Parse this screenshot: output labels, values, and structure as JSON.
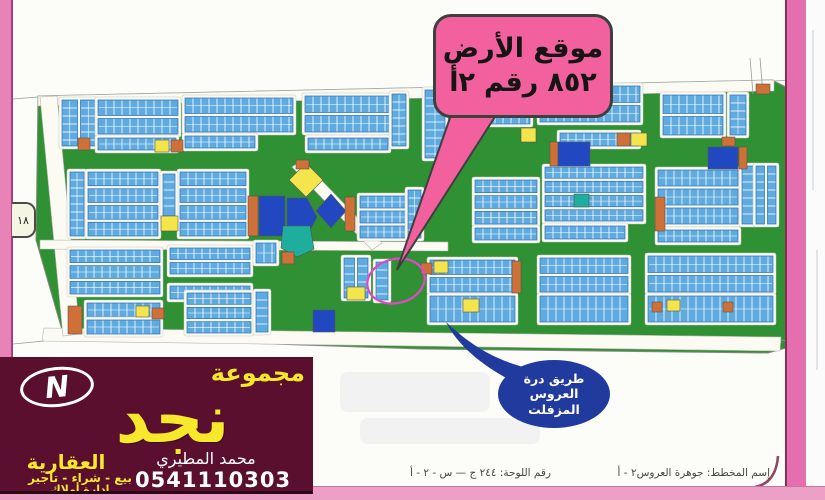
{
  "tab": {
    "label": "١٨"
  },
  "callout": {
    "line1": "موقع الأرض",
    "line2": "أ٢ رقم ٨٥٢",
    "line2_parts": [
      "أ٢",
      "رقم",
      "٨٥٢"
    ],
    "fill": "#f2609d"
  },
  "road_bubble": {
    "lines": [
      "طريق درة",
      "العروس",
      "المزفلت"
    ],
    "fill": "#203a9d"
  },
  "sheet_footer": {
    "plate_label": "رقم اللوحة: ٢٤٤ ج — س - ٢ - أ",
    "plan_label": "إسم المخطط: جوهرة العروس٢ - أ"
  },
  "banner": {
    "group_word": "مجموعة",
    "brand": "نجد",
    "subtitle": "العقارية",
    "services": "بيع - شراء - تاجير",
    "services2": "إدارة أملاك",
    "agent": "محمد المطيري",
    "phone": "0541110303",
    "logo_letter": "N",
    "background": "#5a0f2e",
    "accent": "#f7e82c"
  },
  "frame": {
    "stripe_left": "#e783b7",
    "stripe_right": "#e46fae",
    "strip_bottom": "#eda0c6"
  },
  "map": {
    "colors": {
      "green": "#2f9134",
      "plot": "#5fabe0",
      "plotEdge": "#2d6eb5",
      "royal": "#2148c0",
      "yellow": "#f3e54b",
      "orange": "#cf7038",
      "teal": "#1fae9e",
      "circle": "#e048c8",
      "street": "#fbfbf3"
    },
    "green_outline": [
      [
        38,
        96
      ],
      [
        772,
        80
      ],
      [
        786,
        87
      ],
      [
        786,
        348
      ],
      [
        768,
        353
      ],
      [
        420,
        349
      ],
      [
        64,
        337
      ],
      [
        36,
        240
      ]
    ],
    "roads": [
      [
        [
          38,
          96
        ],
        [
          774,
          80
        ],
        [
          774,
          91
        ],
        [
          38,
          106
        ]
      ],
      [
        [
          44,
          328
        ],
        [
          781,
          337
        ],
        [
          780,
          351
        ],
        [
          42,
          341
        ]
      ],
      [
        [
          40,
          97
        ],
        [
          57,
          96
        ],
        [
          80,
          334
        ],
        [
          63,
          336
        ]
      ],
      [
        [
          40,
          240
        ],
        [
          448,
          242
        ],
        [
          448,
          251
        ],
        [
          40,
          249
        ]
      ],
      [
        [
          292,
          167
        ],
        [
          302,
          160
        ],
        [
          382,
          243
        ],
        [
          372,
          250
        ]
      ]
    ],
    "blocks": [
      [
        62,
        100,
        34,
        46,
        2,
        "v"
      ],
      [
        98,
        100,
        80,
        34,
        2,
        "h"
      ],
      [
        98,
        138,
        78,
        12,
        1,
        "h"
      ],
      [
        185,
        98,
        108,
        34,
        2,
        "h"
      ],
      [
        185,
        136,
        70,
        12,
        1,
        "h"
      ],
      [
        305,
        96,
        85,
        36,
        2,
        "h"
      ],
      [
        308,
        138,
        80,
        12,
        1,
        "h"
      ],
      [
        392,
        94,
        14,
        52,
        1,
        "v"
      ],
      [
        425,
        90,
        20,
        68,
        1,
        "v"
      ],
      [
        455,
        88,
        75,
        36,
        2,
        "h"
      ],
      [
        540,
        86,
        100,
        36,
        2,
        "h"
      ],
      [
        560,
        133,
        78,
        13,
        1,
        "h"
      ],
      [
        663,
        95,
        60,
        40,
        2,
        "h"
      ],
      [
        730,
        95,
        16,
        40,
        1,
        "v"
      ],
      [
        70,
        172,
        14,
        64,
        1,
        "v"
      ],
      [
        88,
        172,
        70,
        64,
        4,
        "h"
      ],
      [
        180,
        172,
        66,
        64,
        4,
        "h"
      ],
      [
        163,
        174,
        12,
        42,
        1,
        "v"
      ],
      [
        360,
        196,
        46,
        42,
        3,
        "h"
      ],
      [
        408,
        190,
        13,
        48,
        1,
        "v"
      ],
      [
        475,
        180,
        62,
        44,
        3,
        "h"
      ],
      [
        475,
        228,
        62,
        12,
        1,
        "h"
      ],
      [
        545,
        167,
        98,
        54,
        4,
        "h"
      ],
      [
        545,
        226,
        80,
        13,
        1,
        "h"
      ],
      [
        658,
        170,
        80,
        54,
        3,
        "h"
      ],
      [
        658,
        230,
        80,
        12,
        1,
        "h"
      ],
      [
        742,
        166,
        12,
        58,
        1,
        "v"
      ],
      [
        756,
        166,
        20,
        58,
        2,
        "v"
      ],
      [
        70,
        250,
        90,
        44,
        3,
        "h"
      ],
      [
        170,
        248,
        80,
        26,
        2,
        "h"
      ],
      [
        170,
        286,
        80,
        13,
        1,
        "h"
      ],
      [
        87,
        303,
        73,
        14,
        1,
        "h"
      ],
      [
        87,
        320,
        73,
        14,
        1,
        "h"
      ],
      [
        187,
        293,
        64,
        40,
        3,
        "h"
      ],
      [
        256,
        292,
        12,
        40,
        1,
        "v"
      ],
      [
        256,
        243,
        20,
        20,
        1,
        "h"
      ],
      [
        344,
        258,
        24,
        40,
        2,
        "v"
      ],
      [
        376,
        262,
        12,
        38,
        1,
        "v"
      ],
      [
        430,
        260,
        85,
        32,
        2,
        "h"
      ],
      [
        430,
        296,
        85,
        26,
        1,
        "h"
      ],
      [
        540,
        258,
        88,
        34,
        2,
        "h"
      ],
      [
        540,
        296,
        88,
        26,
        1,
        "h"
      ],
      [
        648,
        256,
        125,
        36,
        2,
        "h"
      ],
      [
        648,
        296,
        125,
        26,
        1,
        "h"
      ]
    ],
    "specials": [
      {
        "x": 155,
        "y": 140,
        "w": 14,
        "h": 12,
        "c": "yellow"
      },
      {
        "x": 171,
        "y": 140,
        "w": 12,
        "h": 12,
        "c": "orange"
      },
      {
        "x": 78,
        "y": 138,
        "w": 12,
        "h": 12,
        "c": "orange"
      },
      {
        "x": 161,
        "y": 216,
        "w": 17,
        "h": 15,
        "c": "yellow"
      },
      {
        "x": 248,
        "y": 196,
        "w": 10,
        "h": 40,
        "c": "orange"
      },
      {
        "x": 259,
        "y": 196,
        "w": 26,
        "h": 40,
        "c": "royal"
      },
      {
        "pts": [
          [
            287,
            198
          ],
          [
            307,
            198
          ],
          [
            317,
            217
          ],
          [
            307,
            236
          ],
          [
            287,
            236
          ]
        ],
        "c": "royal"
      },
      {
        "pts": [
          [
            306,
            163
          ],
          [
            323,
            180
          ],
          [
            306,
            197
          ],
          [
            289,
            180
          ]
        ],
        "c": "yellow"
      },
      {
        "x": 296,
        "y": 160,
        "w": 13,
        "h": 9,
        "c": "orange"
      },
      {
        "pts": [
          [
            331,
            194
          ],
          [
            346,
            211
          ],
          [
            331,
            228
          ],
          [
            316,
            211
          ]
        ],
        "c": "royal"
      },
      {
        "pts": [
          [
            283,
            226
          ],
          [
            310,
            226
          ],
          [
            314,
            249
          ],
          [
            297,
            257
          ],
          [
            281,
            248
          ]
        ],
        "c": "teal"
      },
      {
        "x": 345,
        "y": 197,
        "w": 10,
        "h": 34,
        "c": "orange"
      },
      {
        "x": 136,
        "y": 306,
        "w": 13,
        "h": 11,
        "c": "yellow"
      },
      {
        "x": 152,
        "y": 308,
        "w": 12,
        "h": 11,
        "c": "orange"
      },
      {
        "x": 68,
        "y": 306,
        "w": 14,
        "h": 28,
        "c": "orange"
      },
      {
        "x": 313,
        "y": 310,
        "w": 22,
        "h": 22,
        "c": "royal"
      },
      {
        "x": 347,
        "y": 287,
        "w": 18,
        "h": 13,
        "c": "yellow"
      },
      {
        "x": 617,
        "y": 133,
        "w": 13,
        "h": 13,
        "c": "orange"
      },
      {
        "x": 631,
        "y": 133,
        "w": 16,
        "h": 13,
        "c": "yellow"
      },
      {
        "x": 550,
        "y": 142,
        "w": 8,
        "h": 24,
        "c": "orange"
      },
      {
        "x": 558,
        "y": 142,
        "w": 32,
        "h": 24,
        "c": "royal"
      },
      {
        "x": 708,
        "y": 147,
        "w": 30,
        "h": 22,
        "c": "royal"
      },
      {
        "x": 739,
        "y": 147,
        "w": 8,
        "h": 22,
        "c": "orange"
      },
      {
        "x": 722,
        "y": 137,
        "w": 13,
        "h": 9,
        "c": "orange"
      },
      {
        "x": 655,
        "y": 197,
        "w": 10,
        "h": 34,
        "c": "orange"
      },
      {
        "x": 434,
        "y": 261,
        "w": 14,
        "h": 12,
        "c": "yellow"
      },
      {
        "x": 421,
        "y": 263,
        "w": 11,
        "h": 11,
        "c": "orange"
      },
      {
        "x": 512,
        "y": 261,
        "w": 9,
        "h": 32,
        "c": "orange"
      },
      {
        "x": 463,
        "y": 299,
        "w": 16,
        "h": 13,
        "c": "yellow"
      },
      {
        "x": 667,
        "y": 300,
        "w": 13,
        "h": 11,
        "c": "yellow"
      },
      {
        "x": 652,
        "y": 302,
        "w": 10,
        "h": 10,
        "c": "orange"
      },
      {
        "x": 723,
        "y": 302,
        "w": 10,
        "h": 10,
        "c": "orange"
      },
      {
        "x": 756,
        "y": 84,
        "w": 14,
        "h": 10,
        "c": "orange"
      },
      {
        "x": 574,
        "y": 194,
        "w": 15,
        "h": 13,
        "c": "teal"
      },
      {
        "x": 521,
        "y": 128,
        "w": 15,
        "h": 14,
        "c": "yellow"
      },
      {
        "x": 282,
        "y": 252,
        "w": 12,
        "h": 12,
        "c": "orange"
      }
    ],
    "faint_lines": [
      [
        13,
        99,
        38,
        97
      ],
      [
        13,
        344,
        44,
        341
      ],
      [
        774,
        81,
        790,
        80
      ],
      [
        781,
        340,
        806,
        343
      ],
      [
        750,
        58,
        753,
        94
      ],
      [
        760,
        58,
        763,
        94
      ]
    ],
    "corner_curve": "M 755,487 Q 776,483 778,456",
    "location_circle": {
      "cx": 396,
      "cy": 281,
      "rx": 29,
      "ry": 22,
      "rot": -14
    },
    "callout_tail": [
      [
        452,
        112
      ],
      [
        498,
        112
      ],
      [
        397,
        270
      ]
    ],
    "bubble_tail": "M446,322 C478,352 504,364 545,372 L518,384 C487,369 459,348 446,322 Z"
  }
}
